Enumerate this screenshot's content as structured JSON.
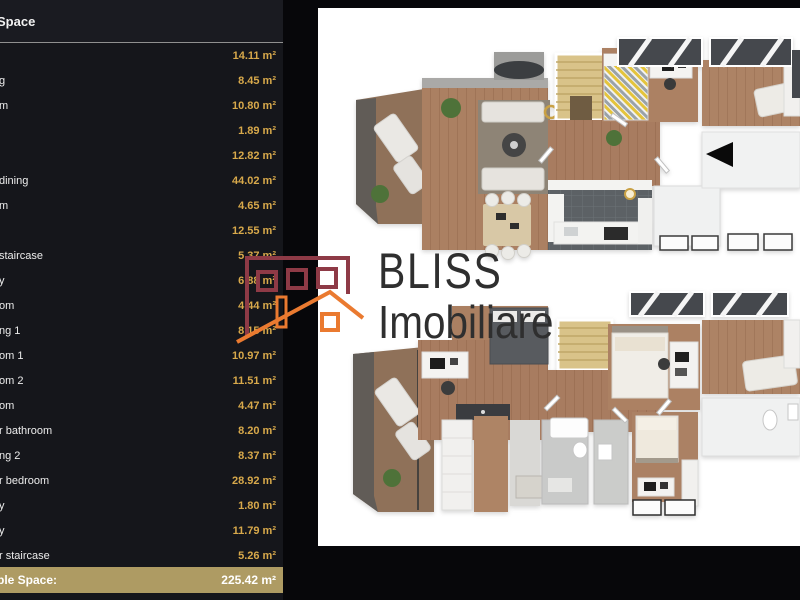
{
  "sidebar": {
    "header_label": "Space",
    "rows": [
      {
        "label": "",
        "area": "14.11 m²"
      },
      {
        "label": "g",
        "area": "8.45 m²"
      },
      {
        "label": "m",
        "area": "10.80 m²"
      },
      {
        "label": "",
        "area": "1.89 m²"
      },
      {
        "label": "",
        "area": "12.82 m²"
      },
      {
        "label": "dining",
        "area": "44.02 m²"
      },
      {
        "label": "m",
        "area": "4.65 m²"
      },
      {
        "label": "",
        "area": "12.55 m²"
      },
      {
        "label": "staircase",
        "area": "5.37 m²"
      },
      {
        "label": "y",
        "area": "6.88 m²"
      },
      {
        "label": "om",
        "area": "4.44 m²"
      },
      {
        "label": "ng 1",
        "area": "8.15 m²"
      },
      {
        "label": "om 1",
        "area": "10.97 m²"
      },
      {
        "label": "om 2",
        "area": "11.51 m²"
      },
      {
        "label": "om",
        "area": "4.47 m²"
      },
      {
        "label": "r bathroom",
        "area": "8.20 m²"
      },
      {
        "label": "ng 2",
        "area": "8.37 m²"
      },
      {
        "label": "r bedroom",
        "area": "28.92 m²"
      },
      {
        "label": "y",
        "area": "1.80 m²"
      },
      {
        "label": "y",
        "area": "11.79 m²"
      },
      {
        "label": "r staircase",
        "area": "5.26 m²"
      }
    ],
    "total": {
      "label": "ble Space:",
      "area": "225.42 m²"
    }
  },
  "watermark": {
    "brand": "BLISS",
    "brand_sub": "Imobiliare"
  },
  "colors": {
    "sidebar_bg": "#15161b",
    "sidebar_header_bg": "#1a1b21",
    "area_value_gold": "#d8a94b",
    "total_bar_bg": "#ae9b63",
    "logo_maroon": "#8e3a46",
    "logo_orange": "#ea7a30",
    "plan_canvas": "#ffffff",
    "wood_floor": "#ab8062",
    "kitchen_tile": "#5c6165",
    "staircase": "#d9c389"
  }
}
